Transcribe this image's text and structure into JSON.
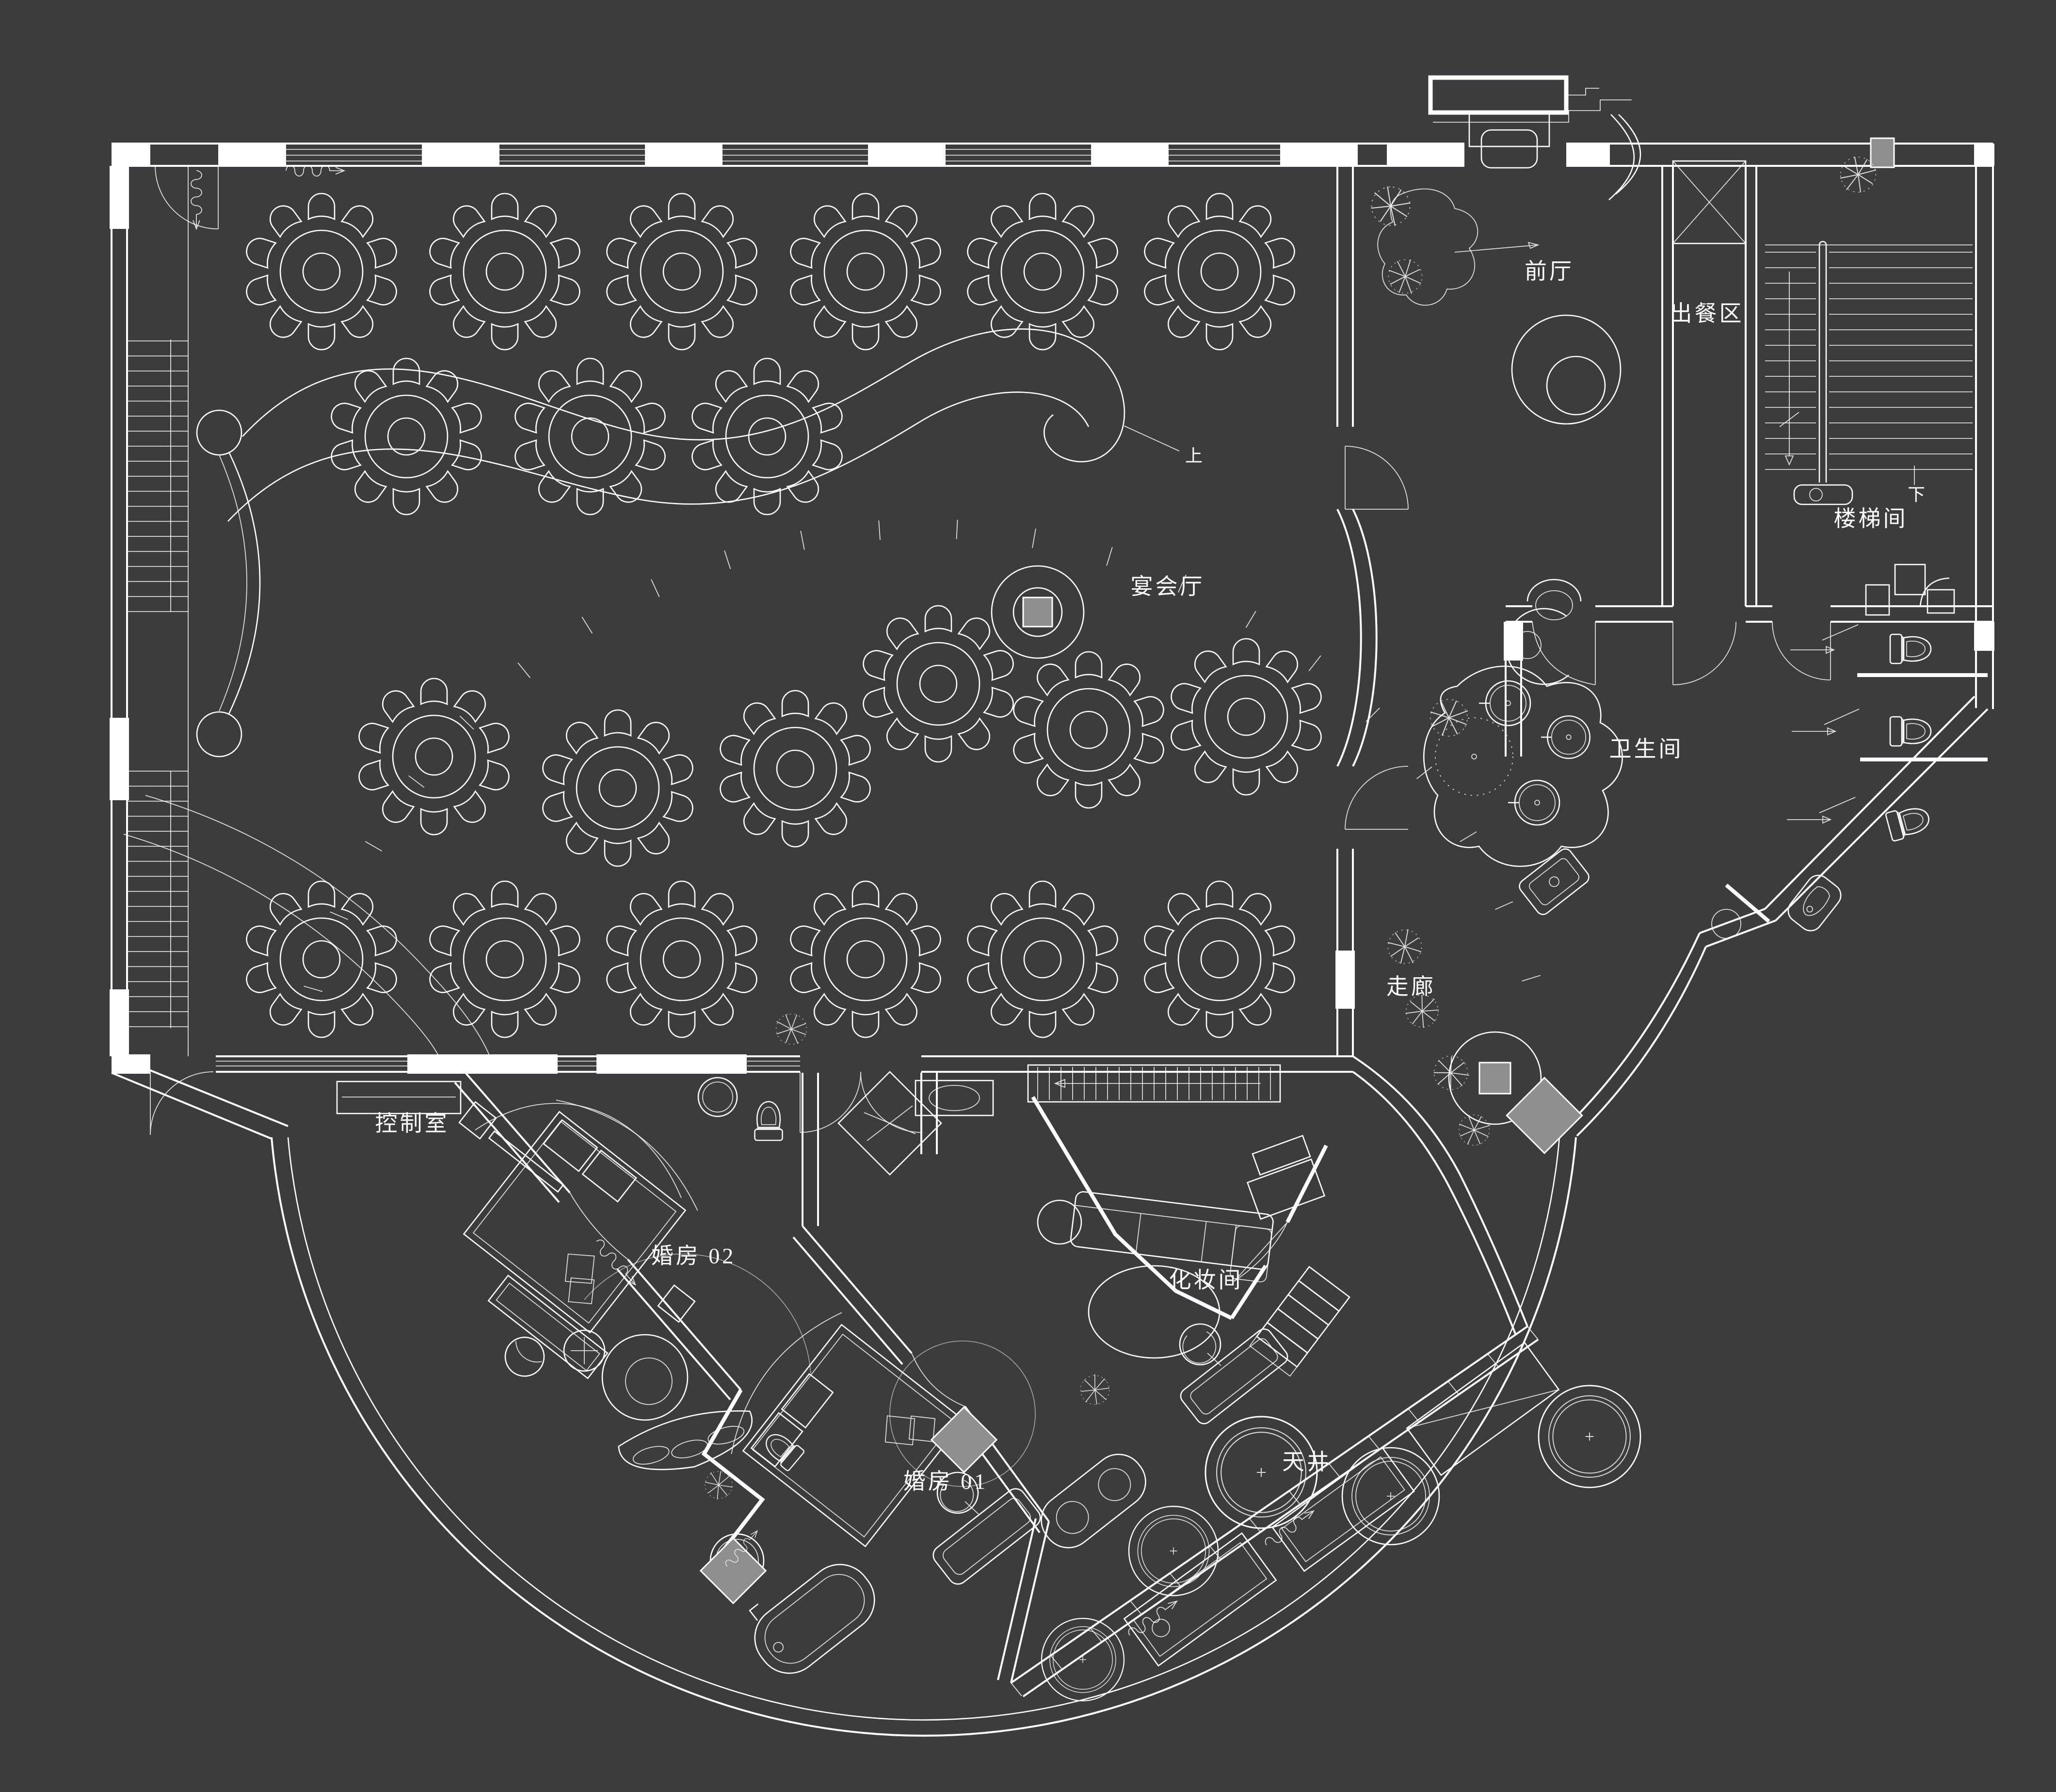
{
  "plan": {
    "type": "banquet-hall-floor-plan",
    "colors": {
      "background": "#3c3c3e",
      "line": "#ffffff",
      "column_fill": "#8f8f91"
    }
  },
  "rooms": [
    {
      "id": "front-hall",
      "label": "前厅"
    },
    {
      "id": "serving-area",
      "label": "出餐区"
    },
    {
      "id": "stair-room",
      "label": "楼梯间"
    },
    {
      "id": "banquet-hall",
      "label": "宴会厅"
    },
    {
      "id": "restroom",
      "label": "卫生间"
    },
    {
      "id": "corridor",
      "label": "走廊"
    },
    {
      "id": "control-room",
      "label": "控制室"
    },
    {
      "id": "bridal-room-02",
      "label": "婚房 02"
    },
    {
      "id": "makeup-room",
      "label": "化妆间"
    },
    {
      "id": "bridal-room-01",
      "label": "婚房 01"
    },
    {
      "id": "courtyard",
      "label": "天井"
    }
  ],
  "annotations": {
    "stair_up": "上",
    "stair_down": "下"
  },
  "banquet_tables": {
    "count": 21,
    "seats_per_table": 10,
    "positions": [
      [
        663,
        560
      ],
      [
        1041,
        560
      ],
      [
        1406,
        560
      ],
      [
        1785,
        560
      ],
      [
        2150,
        560
      ],
      [
        2515,
        560
      ],
      [
        838,
        900
      ],
      [
        1217,
        900
      ],
      [
        1582,
        900
      ],
      [
        895,
        1560
      ],
      [
        1274,
        1625
      ],
      [
        1640,
        1585
      ],
      [
        1935,
        1410
      ],
      [
        2245,
        1505
      ],
      [
        2570,
        1478
      ],
      [
        663,
        1978
      ],
      [
        1041,
        1978
      ],
      [
        1406,
        1978
      ],
      [
        1785,
        1978
      ],
      [
        2150,
        1978
      ],
      [
        2515,
        1978
      ]
    ]
  },
  "planters": [
    [
      2601,
      3036,
      1.15
    ],
    [
      2868,
      3085,
      1.0
    ],
    [
      2420,
      3198,
      0.92
    ],
    [
      3278,
      2962,
      1.05
    ],
    [
      2233,
      3422,
      0.85
    ]
  ],
  "plants": [
    [
      2868,
      425,
      1.2
    ],
    [
      2898,
      570,
      1.05
    ],
    [
      3832,
      360,
      1.1
    ],
    [
      2988,
      1480,
      1.15
    ],
    [
      2897,
      1952,
      1.05
    ],
    [
      2933,
      2085,
      1.0
    ],
    [
      2992,
      2212,
      1.05
    ],
    [
      3040,
      2330,
      0.95
    ],
    [
      1632,
      2122,
      0.95
    ],
    [
      2258,
      2866,
      0.9
    ],
    [
      1482,
      3062,
      0.85
    ]
  ]
}
